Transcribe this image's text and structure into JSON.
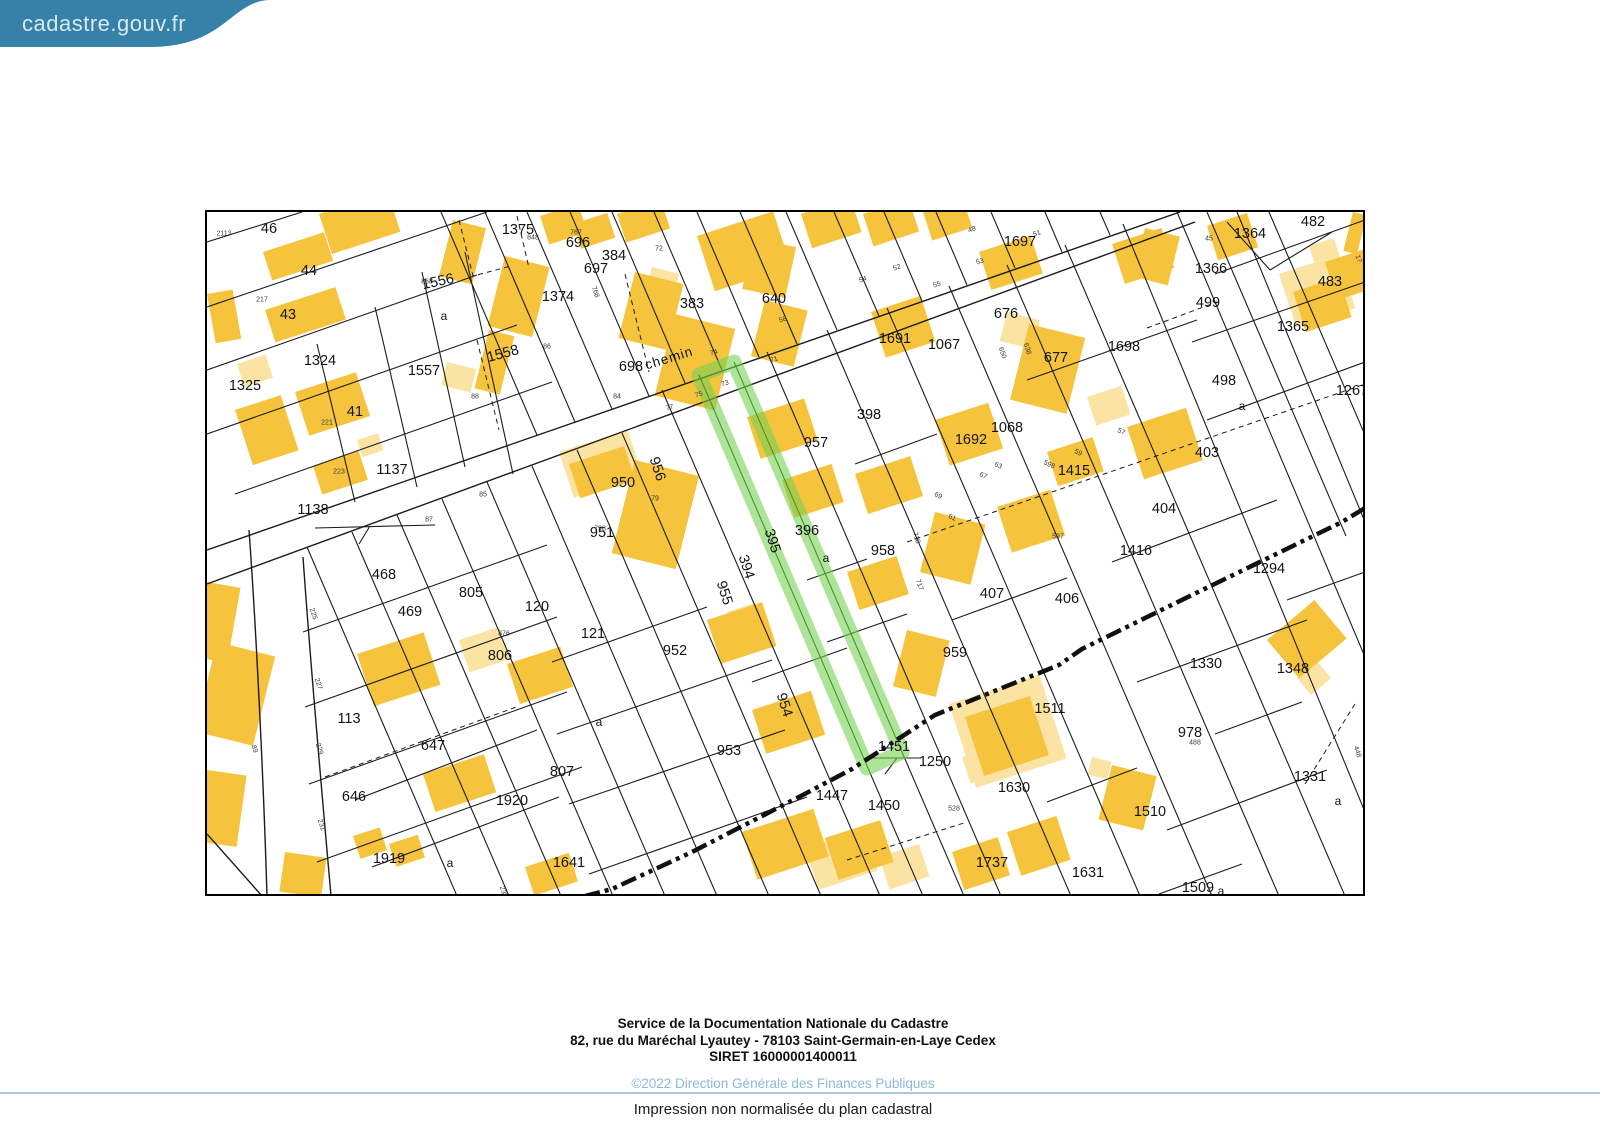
{
  "header": {
    "logo_text": "cadastre.gouv.fr"
  },
  "colors": {
    "banner": "#3581a7",
    "building": "#f6c33c",
    "building-light": "#fbe3a4",
    "highlight": "rgba(116,210,84,0.60)",
    "line": "#1c1c1c",
    "copy-blue": "#8db9d9",
    "divider": "#a9c8dd"
  },
  "map": {
    "highlighted_parcel": "395",
    "road_name": "chemin",
    "labels": [
      {
        "t": "46",
        "x": 62,
        "y": 17
      },
      {
        "t": "44",
        "x": 102,
        "y": 59
      },
      {
        "t": "43",
        "x": 81,
        "y": 103
      },
      {
        "t": "1324",
        "x": 113,
        "y": 149
      },
      {
        "t": "1325",
        "x": 38,
        "y": 174
      },
      {
        "t": "41",
        "x": 148,
        "y": 200
      },
      {
        "t": "1556",
        "x": 231,
        "y": 70,
        "r": -12
      },
      {
        "t": "1557",
        "x": 217,
        "y": 159
      },
      {
        "t": "1558",
        "x": 296,
        "y": 142,
        "r": -15
      },
      {
        "t": "1137",
        "x": 185,
        "y": 258
      },
      {
        "t": "1138",
        "x": 106,
        "y": 298
      },
      {
        "t": "1375",
        "x": 311,
        "y": 18
      },
      {
        "t": "696",
        "x": 371,
        "y": 31
      },
      {
        "t": "697",
        "x": 389,
        "y": 57
      },
      {
        "t": "384",
        "x": 407,
        "y": 44
      },
      {
        "t": "1374",
        "x": 351,
        "y": 85
      },
      {
        "t": "383",
        "x": 485,
        "y": 92
      },
      {
        "t": "640",
        "x": 567,
        "y": 87
      },
      {
        "t": "698",
        "x": 424,
        "y": 155
      },
      {
        "t": "1697",
        "x": 813,
        "y": 30
      },
      {
        "t": "676",
        "x": 799,
        "y": 102
      },
      {
        "t": "1691",
        "x": 688,
        "y": 127
      },
      {
        "t": "1067",
        "x": 737,
        "y": 133
      },
      {
        "t": "677",
        "x": 849,
        "y": 146
      },
      {
        "t": "1698",
        "x": 917,
        "y": 135
      },
      {
        "t": "1364",
        "x": 1043,
        "y": 22
      },
      {
        "t": "482",
        "x": 1106,
        "y": 10
      },
      {
        "t": "1366",
        "x": 1004,
        "y": 57
      },
      {
        "t": "483",
        "x": 1123,
        "y": 70
      },
      {
        "t": "499",
        "x": 1001,
        "y": 91
      },
      {
        "t": "1365",
        "x": 1086,
        "y": 115
      },
      {
        "t": "1267",
        "x": 1145,
        "y": 179
      },
      {
        "t": "498",
        "x": 1017,
        "y": 169
      },
      {
        "t": "398",
        "x": 662,
        "y": 203
      },
      {
        "t": "957",
        "x": 609,
        "y": 231
      },
      {
        "t": "1692",
        "x": 764,
        "y": 228
      },
      {
        "t": "1068",
        "x": 800,
        "y": 216
      },
      {
        "t": "1415",
        "x": 867,
        "y": 259
      },
      {
        "t": "403",
        "x": 1000,
        "y": 241
      },
      {
        "t": "404",
        "x": 957,
        "y": 297
      },
      {
        "t": "950",
        "x": 416,
        "y": 271
      },
      {
        "t": "956",
        "x": 450,
        "y": 257,
        "r": 72
      },
      {
        "t": "951",
        "x": 395,
        "y": 321
      },
      {
        "t": "394",
        "x": 539,
        "y": 355,
        "r": 72
      },
      {
        "t": "395",
        "x": 565,
        "y": 329,
        "r": 72
      },
      {
        "t": "396",
        "x": 600,
        "y": 319
      },
      {
        "t": "958",
        "x": 676,
        "y": 339
      },
      {
        "t": "955",
        "x": 517,
        "y": 381,
        "r": 72
      },
      {
        "t": "1416",
        "x": 929,
        "y": 339
      },
      {
        "t": "1294",
        "x": 1062,
        "y": 357
      },
      {
        "t": "468",
        "x": 177,
        "y": 363
      },
      {
        "t": "469",
        "x": 203,
        "y": 400
      },
      {
        "t": "805",
        "x": 264,
        "y": 381
      },
      {
        "t": "120",
        "x": 330,
        "y": 395
      },
      {
        "t": "121",
        "x": 386,
        "y": 422
      },
      {
        "t": "806",
        "x": 293,
        "y": 444
      },
      {
        "t": "952",
        "x": 468,
        "y": 439
      },
      {
        "t": "407",
        "x": 785,
        "y": 382
      },
      {
        "t": "406",
        "x": 860,
        "y": 387
      },
      {
        "t": "959",
        "x": 748,
        "y": 441
      },
      {
        "t": "1330",
        "x": 999,
        "y": 452
      },
      {
        "t": "1348",
        "x": 1086,
        "y": 457
      },
      {
        "t": "113",
        "x": 142,
        "y": 507
      },
      {
        "t": "647",
        "x": 226,
        "y": 534
      },
      {
        "t": "954",
        "x": 577,
        "y": 493,
        "r": 72
      },
      {
        "t": "953",
        "x": 522,
        "y": 539
      },
      {
        "t": "1511",
        "x": 843,
        "y": 497
      },
      {
        "t": "978",
        "x": 983,
        "y": 521
      },
      {
        "t": "1451",
        "x": 687,
        "y": 535
      },
      {
        "t": "1250",
        "x": 728,
        "y": 550
      },
      {
        "t": "807",
        "x": 355,
        "y": 560
      },
      {
        "t": "646",
        "x": 147,
        "y": 585
      },
      {
        "t": "1920",
        "x": 305,
        "y": 589
      },
      {
        "t": "1447",
        "x": 625,
        "y": 584
      },
      {
        "t": "1450",
        "x": 677,
        "y": 594
      },
      {
        "t": "1630",
        "x": 807,
        "y": 576
      },
      {
        "t": "1510",
        "x": 943,
        "y": 600
      },
      {
        "t": "1331",
        "x": 1103,
        "y": 565
      },
      {
        "t": "1919",
        "x": 182,
        "y": 647
      },
      {
        "t": "1641",
        "x": 362,
        "y": 651
      },
      {
        "t": "1737",
        "x": 785,
        "y": 651
      },
      {
        "t": "1631",
        "x": 881,
        "y": 661
      },
      {
        "t": "1509",
        "x": 991,
        "y": 676
      },
      {
        "t": "a",
        "x": 1035,
        "y": 194,
        "cls": "lt"
      },
      {
        "t": "a",
        "x": 619,
        "y": 346,
        "cls": "lt"
      },
      {
        "t": "a",
        "x": 237,
        "y": 104,
        "cls": "lt"
      },
      {
        "t": "a",
        "x": 1131,
        "y": 589,
        "cls": "lt"
      },
      {
        "t": "a",
        "x": 243,
        "y": 651,
        "cls": "lt"
      },
      {
        "t": "a",
        "x": 392,
        "y": 510,
        "cls": "lt"
      },
      {
        "t": "a",
        "x": 1014,
        "y": 679,
        "cls": "lt"
      },
      {
        "t": "chemin",
        "x": 462,
        "y": 146,
        "r": -17,
        "cls": "road"
      },
      {
        "t": "2113",
        "x": 17,
        "y": 22,
        "cls": "sm"
      },
      {
        "t": "217",
        "x": 55,
        "y": 88,
        "cls": "sm"
      },
      {
        "t": "221",
        "x": 120,
        "y": 211,
        "cls": "sm"
      },
      {
        "t": "223",
        "x": 132,
        "y": 260,
        "cls": "sm"
      },
      {
        "t": "868",
        "x": 220,
        "y": 70,
        "cls": "sm"
      },
      {
        "t": "88",
        "x": 268,
        "y": 185,
        "cls": "sm"
      },
      {
        "t": "848",
        "x": 326,
        "y": 26,
        "cls": "sm"
      },
      {
        "t": "767",
        "x": 369,
        "y": 21,
        "cls": "sm"
      },
      {
        "t": "72",
        "x": 452,
        "y": 37,
        "cls": "sm"
      },
      {
        "t": "768",
        "x": 388,
        "y": 80,
        "r": 72,
        "cls": "sm"
      },
      {
        "t": "86",
        "x": 340,
        "y": 135,
        "cls": "sm"
      },
      {
        "t": "84",
        "x": 410,
        "y": 185,
        "cls": "sm"
      },
      {
        "t": "74",
        "x": 507,
        "y": 141,
        "r": -18,
        "cls": "sm"
      },
      {
        "t": "77",
        "x": 463,
        "y": 196,
        "r": -18,
        "cls": "sm"
      },
      {
        "t": "75",
        "x": 492,
        "y": 183,
        "r": -18,
        "cls": "sm"
      },
      {
        "t": "73",
        "x": 518,
        "y": 172,
        "r": -18,
        "cls": "sm"
      },
      {
        "t": "71",
        "x": 567,
        "y": 148,
        "r": -18,
        "cls": "sm"
      },
      {
        "t": "58",
        "x": 576,
        "y": 108,
        "r": -18,
        "cls": "sm"
      },
      {
        "t": "54",
        "x": 656,
        "y": 68,
        "r": -18,
        "cls": "sm"
      },
      {
        "t": "52",
        "x": 690,
        "y": 56,
        "r": -18,
        "cls": "sm"
      },
      {
        "t": "48",
        "x": 765,
        "y": 18,
        "r": -18,
        "cls": "sm"
      },
      {
        "t": "51",
        "x": 830,
        "y": 22,
        "r": -18,
        "cls": "sm"
      },
      {
        "t": "53",
        "x": 773,
        "y": 50,
        "r": -18,
        "cls": "sm"
      },
      {
        "t": "55",
        "x": 730,
        "y": 73,
        "r": -18,
        "cls": "sm"
      },
      {
        "t": "45",
        "x": 1002,
        "y": 27,
        "cls": "sm"
      },
      {
        "t": "17",
        "x": 1151,
        "y": 47,
        "r": 72,
        "cls": "sm"
      },
      {
        "t": "650",
        "x": 795,
        "y": 141,
        "r": 72,
        "cls": "sm"
      },
      {
        "t": "638",
        "x": 820,
        "y": 137,
        "r": 72,
        "cls": "sm"
      },
      {
        "t": "57",
        "x": 914,
        "y": 220,
        "r": 25,
        "cls": "sm"
      },
      {
        "t": "59",
        "x": 871,
        "y": 241,
        "r": 25,
        "cls": "sm"
      },
      {
        "t": "598",
        "x": 842,
        "y": 253,
        "r": 25,
        "cls": "sm"
      },
      {
        "t": "63",
        "x": 791,
        "y": 254,
        "r": 25,
        "cls": "sm"
      },
      {
        "t": "67",
        "x": 776,
        "y": 264,
        "r": 25,
        "cls": "sm"
      },
      {
        "t": "69",
        "x": 731,
        "y": 284,
        "r": 25,
        "cls": "sm"
      },
      {
        "t": "61",
        "x": 745,
        "y": 306,
        "r": 25,
        "cls": "sm"
      },
      {
        "t": "597",
        "x": 851,
        "y": 325,
        "cls": "sm"
      },
      {
        "t": "718",
        "x": 709,
        "y": 326,
        "r": 72,
        "cls": "sm"
      },
      {
        "t": "717",
        "x": 712,
        "y": 373,
        "r": 72,
        "cls": "sm"
      },
      {
        "t": "79",
        "x": 448,
        "y": 287,
        "cls": "sm"
      },
      {
        "t": "798",
        "x": 393,
        "y": 317,
        "cls": "sm"
      },
      {
        "t": "85",
        "x": 276,
        "y": 283,
        "cls": "sm"
      },
      {
        "t": "87",
        "x": 222,
        "y": 308,
        "cls": "sm"
      },
      {
        "t": "876",
        "x": 297,
        "y": 422,
        "cls": "sm"
      },
      {
        "t": "225",
        "x": 106,
        "y": 402,
        "r": 72,
        "cls": "sm"
      },
      {
        "t": "227",
        "x": 111,
        "y": 472,
        "r": 72,
        "cls": "sm"
      },
      {
        "t": "229",
        "x": 112,
        "y": 537,
        "r": 72,
        "cls": "sm"
      },
      {
        "t": "231",
        "x": 114,
        "y": 613,
        "r": 72,
        "cls": "sm"
      },
      {
        "t": "89",
        "x": 47,
        "y": 537,
        "r": 72,
        "cls": "sm"
      },
      {
        "t": "235",
        "x": 296,
        "y": 680,
        "r": 72,
        "cls": "sm"
      },
      {
        "t": "528",
        "x": 747,
        "y": 597,
        "cls": "sm"
      },
      {
        "t": "488",
        "x": 988,
        "y": 531,
        "cls": "sm"
      },
      {
        "t": "448",
        "x": 1150,
        "y": 540,
        "r": 72,
        "cls": "sm"
      }
    ]
  },
  "footer": {
    "line1": "Service de la Documentation Nationale du Cadastre",
    "line2": "82, rue du Maréchal Lyautey - 78103 Saint-Germain-en-Laye Cedex",
    "line3": "SIRET 16000001400011",
    "copyright": "©2022 Direction Générale des Finances Publiques",
    "impression": "Impression non normalisée du plan cadastral"
  }
}
